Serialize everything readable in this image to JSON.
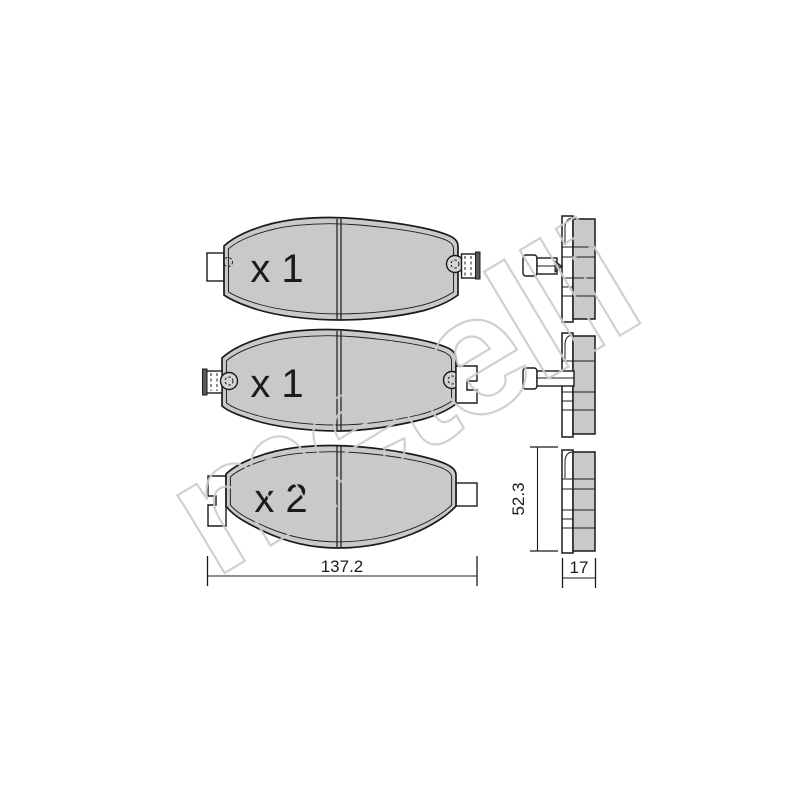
{
  "watermark": {
    "text": "metelli"
  },
  "colors": {
    "pad_fill": "#c9c9c9",
    "line_color": "#1b1b1b",
    "backplate": "#ffffff",
    "clip_cap": "#5a5a5a",
    "watermark_outline": "#cccccc"
  },
  "front_views": [
    {
      "quantity_label": "x 1"
    },
    {
      "quantity_label": "x 1"
    },
    {
      "quantity_label": "x 2"
    }
  ],
  "dimensions": {
    "width_mm": "137.2",
    "height_mm": "52.3",
    "thickness_mm": "17"
  }
}
